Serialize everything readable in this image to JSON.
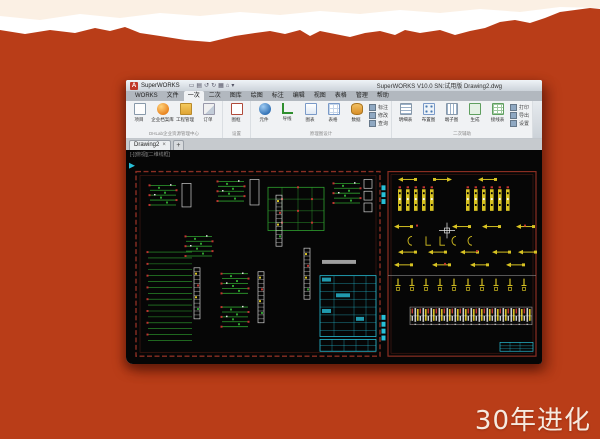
{
  "slide": {
    "caption": "30年进化",
    "caption_color": "#f6eadf",
    "background_color": "#b93d18",
    "top_band_color": "#fbf0e4",
    "torn_edge_color": "#ffffff"
  },
  "window": {
    "titlebar": {
      "app_name": "SuperWORKS",
      "document_title": "SuperWORKS V10.0 SN:试用版  Drawing2.dwg",
      "qat_icons": [
        "▭",
        "▤",
        "↺",
        "↻",
        "▦",
        "⌂",
        "▾"
      ]
    },
    "ribbon": {
      "tabs": [
        {
          "label": "WORKS"
        },
        {
          "label": "文件"
        },
        {
          "label": "一次",
          "active": true
        },
        {
          "label": "二次"
        },
        {
          "label": "图库"
        },
        {
          "label": "绘图"
        },
        {
          "label": "标注"
        },
        {
          "label": "编辑"
        },
        {
          "label": "视图"
        },
        {
          "label": "表格"
        },
        {
          "label": "管理"
        },
        {
          "label": "帮助"
        }
      ],
      "groups": [
        {
          "label": "DHLab企业资源管理中心",
          "items": [
            {
              "label": "项目",
              "icon": "doc"
            },
            {
              "label": "企业档案库",
              "icon": "ball"
            },
            {
              "label": "工程管理",
              "icon": "folder"
            },
            {
              "label": "订单",
              "icon": "pen"
            }
          ]
        },
        {
          "label": "设置",
          "items": [
            {
              "label": "图框",
              "icon": "sheet"
            }
          ]
        },
        {
          "label": "原理图设计",
          "items": [
            {
              "label": "元件",
              "icon": "globe"
            },
            {
              "label": "导线",
              "icon": "wire"
            },
            {
              "label": "图表",
              "icon": "chart"
            },
            {
              "label": "表格",
              "icon": "grid"
            },
            {
              "label": "数据",
              "icon": "db"
            }
          ],
          "minis": [
            {
              "label": "标注"
            },
            {
              "label": "修改"
            },
            {
              "label": "查询"
            }
          ]
        },
        {
          "label": "二次辅助",
          "items": [
            {
              "label": "明细表",
              "icon": "list"
            },
            {
              "label": "布置图",
              "icon": "org"
            },
            {
              "label": "端子图",
              "icon": "term"
            },
            {
              "label": "生成",
              "icon": "gen"
            },
            {
              "label": "接线表",
              "icon": "table"
            }
          ],
          "minis": [
            {
              "label": "打印"
            },
            {
              "label": "导出"
            },
            {
              "label": "设置"
            }
          ]
        }
      ]
    },
    "filetabs": {
      "tab": "Drawing2",
      "close": "×",
      "add": "+"
    },
    "canvas": {
      "viewport_label": "[-][俯视][二维线框]",
      "colors": {
        "background": "#060606",
        "sheet_frame_red": "#8b2f23",
        "schematic_green": "#2fa12f",
        "marker_red": "#c03430",
        "detail_white": "#d8d8d8",
        "diagram_yellow": "#d8c322",
        "table_cyan": "#27c0d8"
      }
    }
  }
}
